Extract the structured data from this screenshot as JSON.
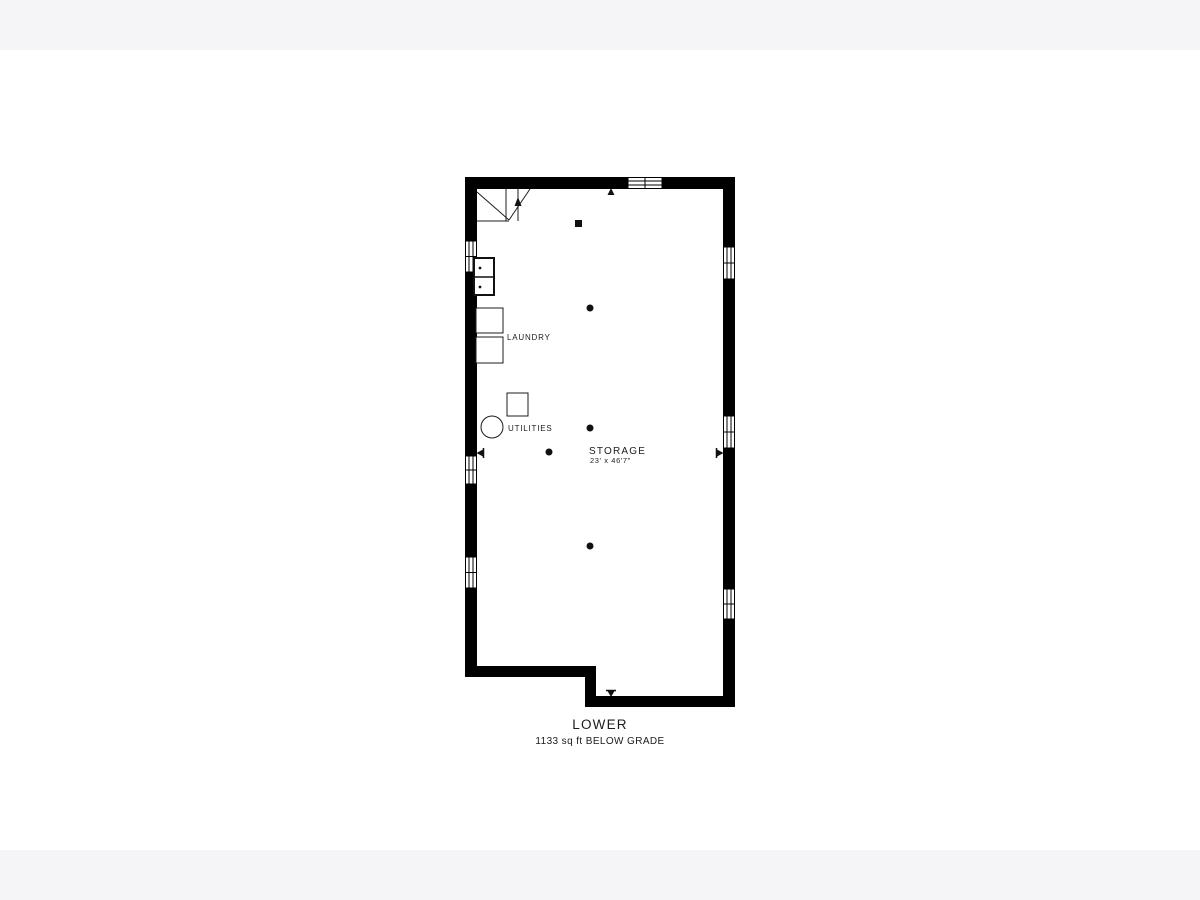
{
  "canvas": {
    "width": 1200,
    "height": 900,
    "background": "#ffffff",
    "letterbox_color": "#f5f4f6"
  },
  "plan": {
    "title": "LOWER",
    "subtitle": "1133 sq ft BELOW GRADE",
    "room": {
      "name": "STORAGE",
      "dimensions": "23' x 46'7\""
    },
    "labels": {
      "laundry": "LAUNDRY",
      "utilities": "UTILITIES"
    },
    "colors": {
      "wall": "#000000",
      "text": "#1c1c1c"
    },
    "icons": [
      "stairs-up-arrow-icon",
      "ref-marker-top-icon",
      "ref-marker-bottom-icon",
      "ref-marker-left-icon",
      "ref-marker-right-icon"
    ],
    "fixtures": [
      "laundry-sink",
      "washer",
      "dryer",
      "furnace",
      "water-heater",
      "support-post-square",
      "support-column-1",
      "support-column-2",
      "support-column-3",
      "support-column-4"
    ]
  }
}
